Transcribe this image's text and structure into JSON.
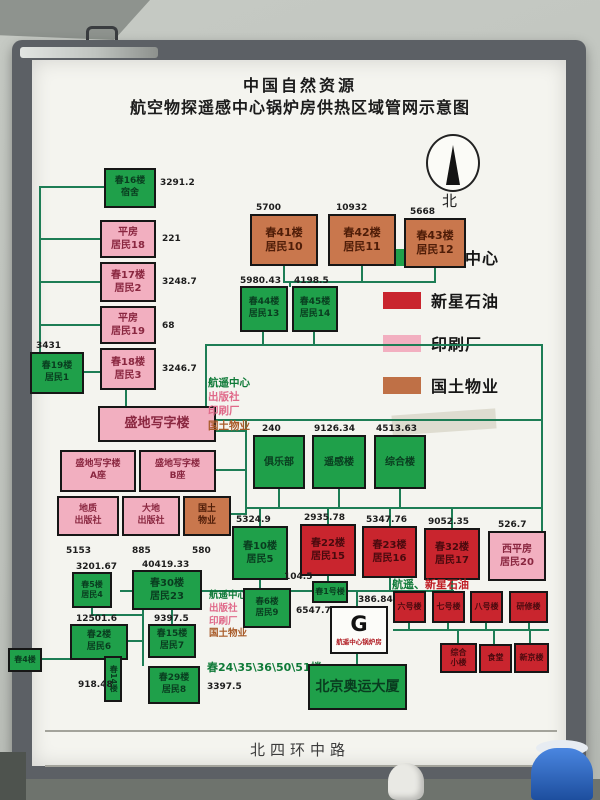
{
  "title": {
    "line1": "中国自然资源",
    "line2": "航空物探遥感中心锅炉房供热区域管网示意图"
  },
  "compass": {
    "north": "北"
  },
  "legend": {
    "items": [
      {
        "label": "航遥中心",
        "color": "#1fa04a"
      },
      {
        "label": "新星石油",
        "color": "#c9252e"
      },
      {
        "label": "印刷厂",
        "color": "#f2afc0"
      },
      {
        "label": "国土物业",
        "color": "#bf7046"
      }
    ]
  },
  "boxes": {
    "chun16": {
      "l1": "春16楼",
      "l2": "宿舍",
      "value": "3291.2"
    },
    "pingfang18": {
      "l1": "平房",
      "l2": "居民18",
      "value": "221"
    },
    "chun17": {
      "l1": "春17楼",
      "l2": "居民2",
      "value": "3248.7"
    },
    "pingfang19": {
      "l1": "平房",
      "l2": "居民19",
      "value": "68"
    },
    "chun18": {
      "l1": "春18楼",
      "l2": "居民3",
      "value": "3246.7"
    },
    "chun19": {
      "l1": "春19楼",
      "l2": "居民1",
      "value": "3431"
    },
    "shengdi": {
      "l1": "盛地写字楼"
    },
    "shengdi_a": {
      "l1": "盛地写字楼",
      "l2": "A座"
    },
    "shengdi_b": {
      "l1": "盛地写字楼",
      "l2": "B座"
    },
    "dizhi": {
      "l1": "地质",
      "l2": "出版社",
      "value": "5153"
    },
    "dadi": {
      "l1": "大地",
      "l2": "出版社",
      "value": "885"
    },
    "guotu": {
      "l1": "国土",
      "l2": "物业",
      "value": "580"
    },
    "chun41": {
      "l1": "春41楼",
      "l2": "居民10",
      "value": "5700"
    },
    "chun42": {
      "l1": "春42楼",
      "l2": "居民11",
      "value": "10932"
    },
    "chun43": {
      "l1": "春43楼",
      "l2": "居民12",
      "value": "5668"
    },
    "chun44": {
      "l1": "春44楼",
      "l2": "居民13",
      "value": "5980.43"
    },
    "chun45": {
      "l1": "春45楼",
      "l2": "居民14",
      "value": "4198.5"
    },
    "julebu": {
      "l1": "俱乐部",
      "value": "240"
    },
    "yaogan": {
      "l1": "遥感楼",
      "value": "9126.34"
    },
    "zonghe": {
      "l1": "综合楼",
      "value": "4513.63"
    },
    "chun10": {
      "l1": "春10楼",
      "l2": "居民5",
      "value": "5324.9"
    },
    "chun22": {
      "l1": "春22楼",
      "l2": "居民15",
      "value": "2935.78"
    },
    "chun23": {
      "l1": "春23楼",
      "l2": "居民16",
      "value": "5347.76"
    },
    "chun32": {
      "l1": "春32楼",
      "l2": "居民17",
      "value": "9052.35"
    },
    "xipingfang": {
      "l1": "西平房",
      "l2": "居民20",
      "value": "526.7"
    },
    "chun5": {
      "l1": "春5楼",
      "l2": "居民4",
      "value": "3201.67"
    },
    "chun30": {
      "l1": "春30楼",
      "l2": "居民23",
      "value": "40419.33"
    },
    "chun2": {
      "l1": "春2楼",
      "l2": "居民6",
      "value": "12501.6"
    },
    "chun15": {
      "l1": "春15楼",
      "l2": "居民7",
      "value": "9397.5"
    },
    "chun14": {
      "l1": "春14楼",
      "value": "918.48"
    },
    "chun4": {
      "l1": "春4楼"
    },
    "chun29": {
      "l1": "春29楼",
      "l2": "居民8"
    },
    "chun6": {
      "l1": "春6楼",
      "l2": "居民9",
      "value": "6547.7"
    },
    "chun1hao": {
      "l1": "春1号楼",
      "value": "104.5"
    },
    "liuhao": {
      "l1": "六号楼"
    },
    "qihao": {
      "l1": "七号楼"
    },
    "bahao": {
      "l1": "八号楼"
    },
    "yanxiu": {
      "l1": "研修楼"
    },
    "zonghexiaolou": {
      "l1": "综合",
      "l2": "小楼"
    },
    "shitang": {
      "l1": "食堂"
    },
    "xinjing": {
      "l1": "新京楼"
    },
    "aoyun": {
      "l1": "北京奥运大厦"
    }
  },
  "gbox": {
    "letter": "G",
    "label": "航遥中心锅炉房",
    "inflow_value": "386.84"
  },
  "notes": {
    "block1": {
      "l1": "航遥中心",
      "l2": "出版社",
      "l3": "印刷厂",
      "l4": "国土物业"
    },
    "block2": {
      "l1": "航遥中心",
      "l2": "出版社",
      "l3": "印刷厂",
      "l4": "国土物业"
    },
    "cluster_label_green": "航遥、",
    "cluster_label_red": "新星石油",
    "chun_list": "春24\\35\\36\\50\\51楼",
    "chun_list_value": "3397.5"
  },
  "road": {
    "label": "北四环中路"
  }
}
